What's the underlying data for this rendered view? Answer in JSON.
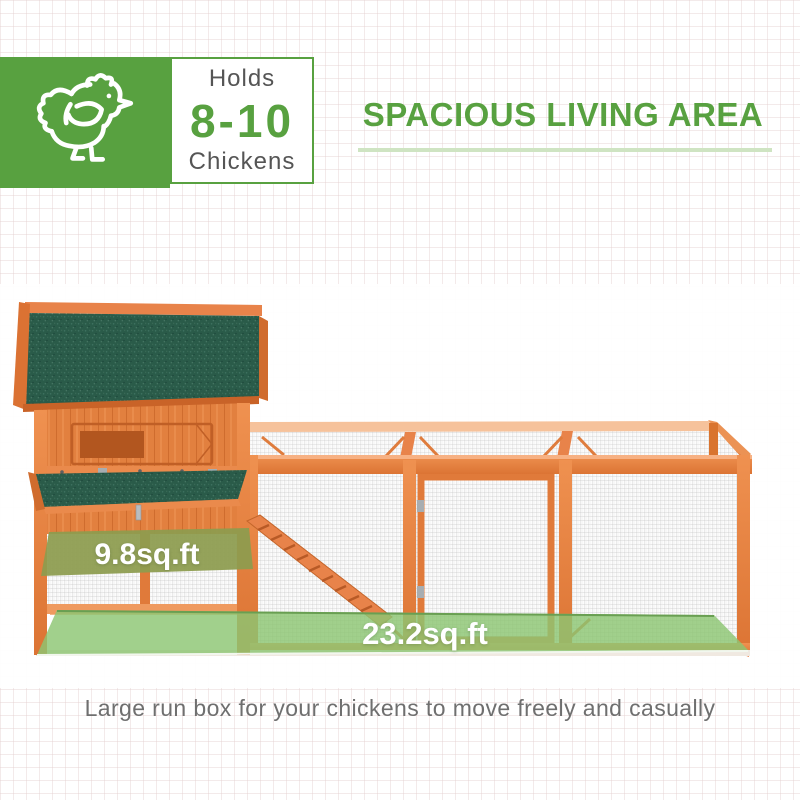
{
  "badge": {
    "holds_label": "Holds",
    "range": "8-10",
    "unit_label": "Chickens",
    "icon": "chicken-icon"
  },
  "heading": {
    "text": "SPACIOUS LIVING AREA"
  },
  "figure": {
    "house_area_label": "9.8sq.ft",
    "run_area_label": "23.2sq.ft"
  },
  "caption": {
    "text": "Large run box for your chickens to move freely and casually"
  },
  "colors": {
    "brand_green": "#58a140",
    "underline_green": "#cfe4c2",
    "wood_orange": "#e07a3a",
    "wood_dark": "#c4662b",
    "roof_green": "#2a5b49",
    "run_floor_green": "#8cc673",
    "house_floor_olive": "#8d9c4f",
    "mesh_gray": "#cccccc",
    "text_gray": "#6f6f6f"
  }
}
